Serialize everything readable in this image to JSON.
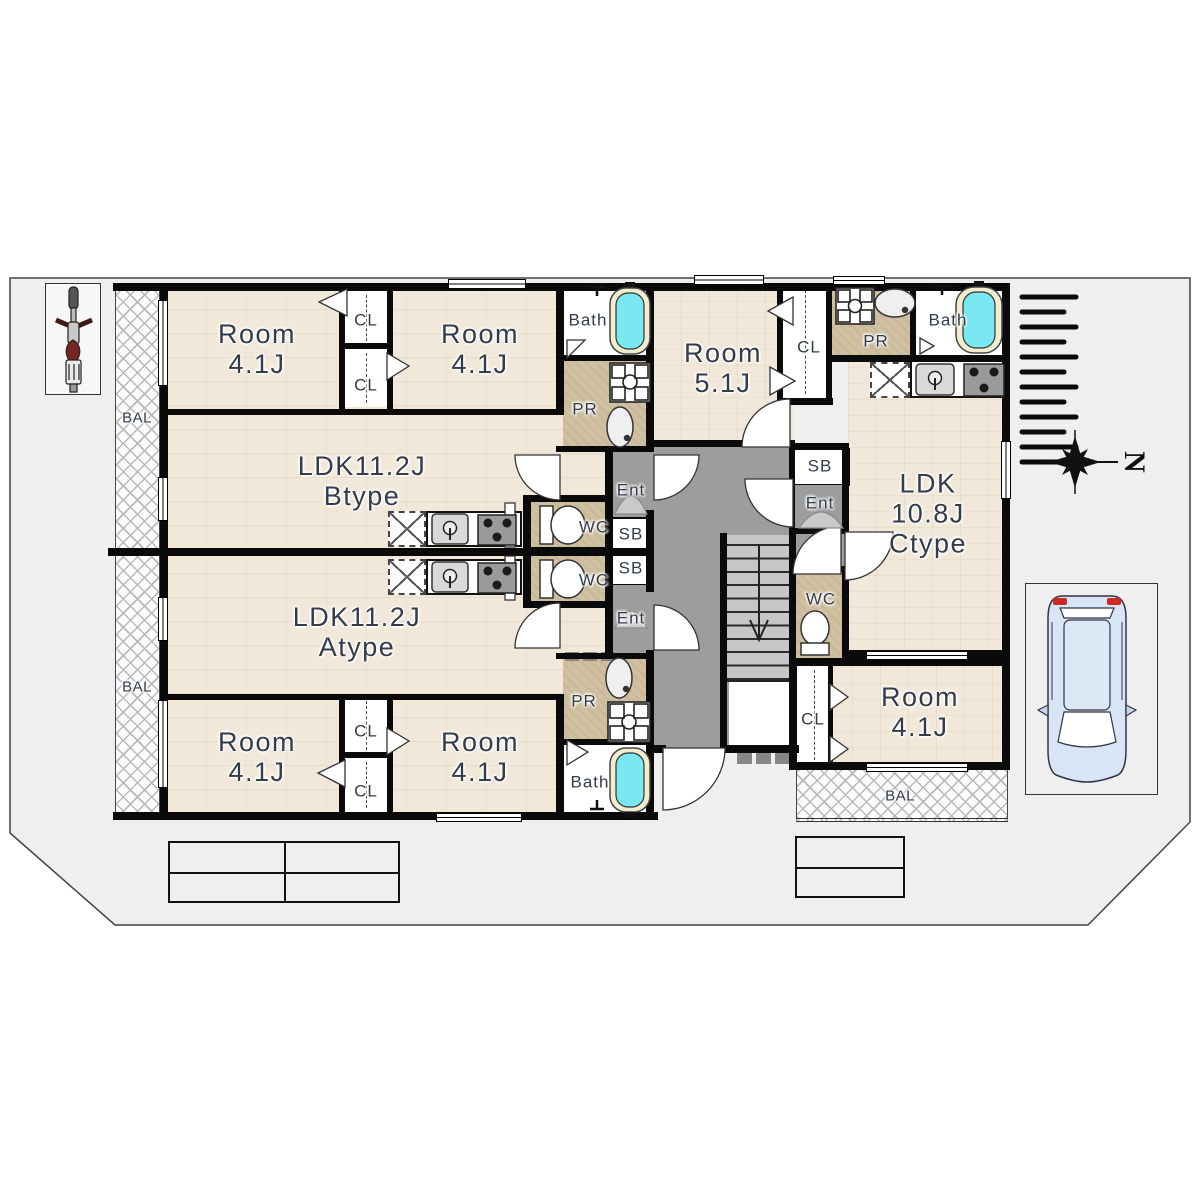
{
  "document": {
    "type": "apartment-floor-plan"
  },
  "rooms": {
    "room_41": {
      "name": "Room",
      "size": "4.1J"
    },
    "room_51": {
      "name": "Room",
      "size": "5.1J"
    },
    "ldk_b": {
      "name": "LDK11.2J",
      "type": "Btype"
    },
    "ldk_a": {
      "name": "LDK11.2J",
      "type": "Atype"
    },
    "ldk_c": {
      "name": "LDK",
      "size": "10.8J",
      "type": "Ctype"
    }
  },
  "labels": {
    "bath": "Bath",
    "powder_room": "PR",
    "toilet": "WC",
    "closet": "CL",
    "shoe_box": "SB",
    "entrance": "Ent",
    "balcony": "BAL",
    "north": "N"
  },
  "colors": {
    "site": "#efefef",
    "wood_floor": "#f2e8da",
    "service_tan": "#cfc0a1",
    "corridor_gray": "#9d9d9d",
    "stairs_gray": "#c6c6c6",
    "bathtub_cyan": "#79e8f1",
    "wall_black": "#0a0a0a",
    "label_ink": "#333c4a",
    "car_blue": "#d8e5f4",
    "moto_seat_red": "#7a2422"
  }
}
